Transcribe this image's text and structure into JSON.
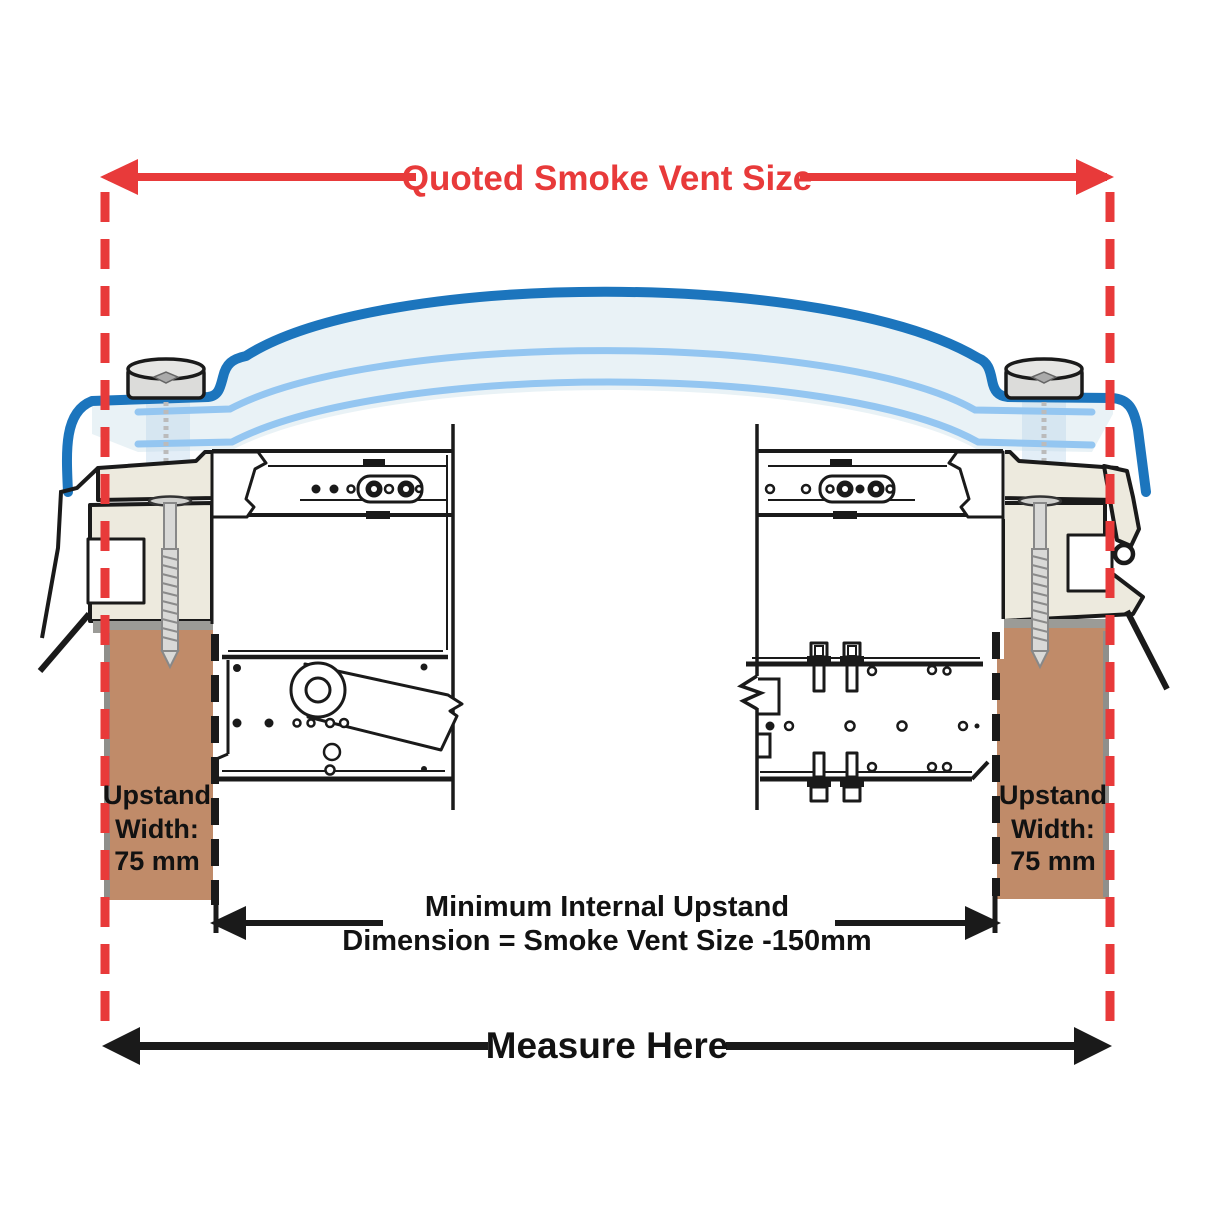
{
  "top_dimension": {
    "label": "Quoted Smoke Vent Size"
  },
  "bottom_dimension": {
    "label": "Measure Here"
  },
  "internal_dimension": {
    "line1": "Minimum Internal Upstand",
    "line2": "Dimension = Smoke Vent Size -150mm"
  },
  "upstand_label": {
    "line1": "Upstand",
    "line2": "Width:",
    "line3": "75 mm"
  },
  "colors": {
    "dimension_red": "#e83a3a",
    "dome_blue": "#1c75bd",
    "glazing_light_blue": "#94c6f1",
    "glazing_fill": "#e9f2f6",
    "timber_brown": "#c08b69",
    "kerb_cream": "#edeade",
    "grey_strip": "#9b9b97",
    "line_black": "#1a1a1a"
  }
}
